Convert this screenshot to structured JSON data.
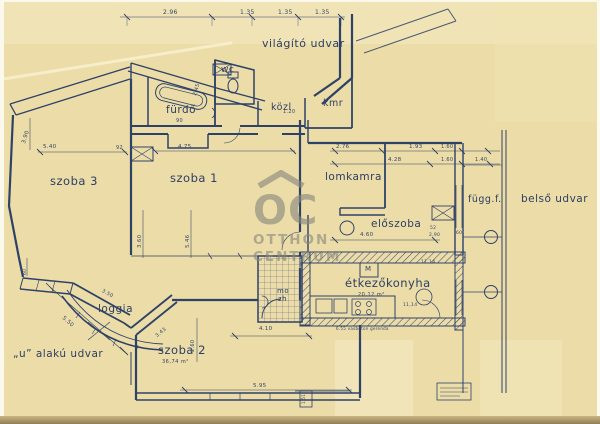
{
  "watermark": {
    "logo": "OC",
    "line1": "OTTHON",
    "line2": "CENTRUM"
  },
  "rooms": {
    "vilagito_udvar": "világító udvar",
    "wc": "wc",
    "furdo": "fürdő",
    "kozl": "közl",
    "kmr": "kmr",
    "szoba3": "szoba 3",
    "szoba1": "szoba 1",
    "lomkamra": "lomkamra",
    "eloszoba": "előszoba",
    "fuggf": "függ.f.",
    "belso_udvar": "belső udvar",
    "etkezokonyha": "étkezőkonyha",
    "etkezokonyha_area": "20,12 m²",
    "mo": "mo",
    "zh": "zh",
    "loggia": "loggia",
    "u_alaku_udvar": "„u” alakú udvar",
    "szoba2": "szoba 2",
    "szoba2_area": "36,74 m²"
  },
  "dims": {
    "d01": "2.96",
    "d02": "1.35",
    "d03": "1.35",
    "d04": "1.35",
    "d05": "90",
    "d06": "2.45",
    "d07": "1.20",
    "d08": "3.90",
    "d09": "5.40",
    "d10": "92",
    "d11": "4.75",
    "d12": "5.46",
    "d13": "3.60",
    "d14": "2.76",
    "d15": "1.93",
    "d16": "1.60",
    "d17": "4.28",
    "d18": "1.60",
    "d19": "1.40",
    "d20": "4.60",
    "d21": "52",
    "d22": "2.90",
    "d23": "60",
    "d24": "4.10",
    "d25": "5.95",
    "d26": "5.50",
    "d27": "3.50",
    "d28": "3.43",
    "d29": "60",
    "d30": "2.60",
    "d31": "11,14",
    "d32": "11,14",
    "d33": "6.55 vasbeton gerenda",
    "d34": "M",
    "d35": "1.51"
  },
  "colors": {
    "paper": "#ecdca7",
    "ink": "#2e4268",
    "watermark": "#87877f"
  }
}
